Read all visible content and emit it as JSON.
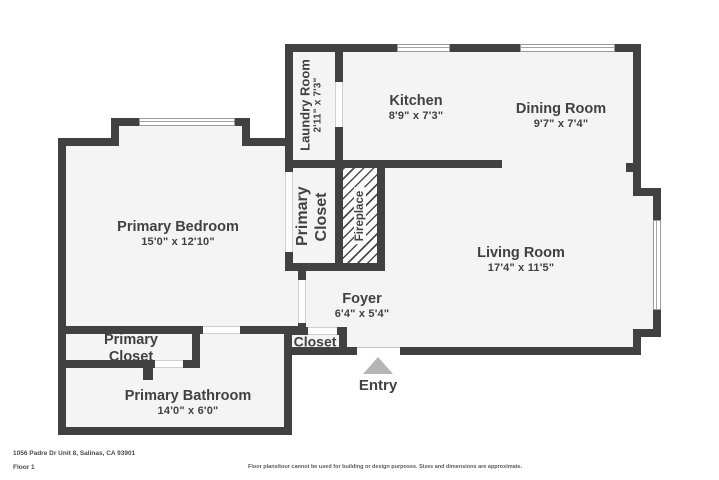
{
  "meta": {
    "address": "1056 Padre Dr Unit 8, Salinas, CA 93901",
    "floor_label": "Floor 1",
    "disclaimer": "Floor plans/tour cannot be used for building or design purposes. Sizes and dimensions are approximate."
  },
  "colors": {
    "wall": "#414141",
    "floor": "#f4f4f4",
    "label": "#414141",
    "entry_arrow": "#b5b5b5"
  },
  "rooms": {
    "laundry": {
      "name": "Laundry Room",
      "dims": "2'11\" x 7'3\""
    },
    "kitchen": {
      "name": "Kitchen",
      "dims": "8'9\" x 7'3\""
    },
    "dining": {
      "name": "Dining Room",
      "dims": "9'7\" x 7'4\""
    },
    "primary_bedroom": {
      "name": "Primary Bedroom",
      "dims": "15'0\" x 12'10\""
    },
    "primary_closet_mid": {
      "name": "Primary Closet"
    },
    "fireplace": {
      "name": "Fireplace"
    },
    "living": {
      "name": "Living Room",
      "dims": "17'4\" x 11'5\""
    },
    "foyer": {
      "name": "Foyer",
      "dims": "6'4\" x 5'4\""
    },
    "primary_closet_sw": {
      "name": "Primary Closet"
    },
    "primary_bathroom": {
      "name": "Primary Bathroom",
      "dims": "14'0\" x 6'0\""
    },
    "entry_closet": {
      "name": "Closet"
    },
    "entry": {
      "name": "Entry"
    }
  }
}
